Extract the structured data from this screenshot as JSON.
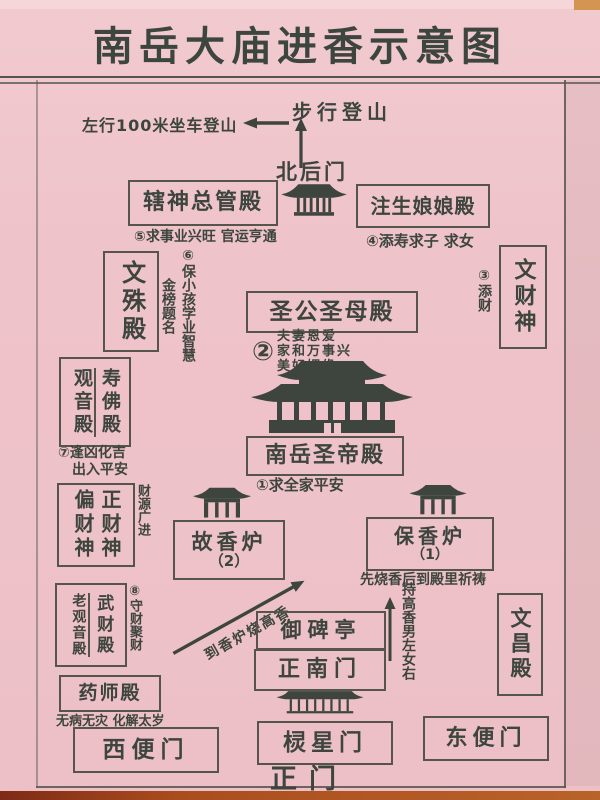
{
  "title": "南岳大庙进香示意图",
  "colors": {
    "paper": "#eec3c9",
    "ink": "#3d453e",
    "line": "#56554c",
    "table": "#a5501f"
  },
  "top_area": {
    "walk_up": "步行登山",
    "ride_up": "左行100米坐车登山",
    "north_back_gate": "北后门"
  },
  "halls": {
    "xiashen": {
      "name": "辖神总管殿",
      "note": "⑤求事业兴旺 官运亨通"
    },
    "zhusheng": {
      "name": "注生娘娘殿",
      "note": "④添寿求子 求女"
    },
    "wenshu": {
      "name": "文殊殿",
      "note_col1": "⑥保小孩学业智慧",
      "note_col2": "金榜题名"
    },
    "wencaishen": {
      "name": "文财神",
      "note": "③添财"
    },
    "shenggongshengmu": {
      "name": "圣公圣母殿",
      "badge": "②",
      "notes": [
        "夫妻恩爱",
        "家和万事兴",
        "美好姻缘"
      ]
    },
    "shengdi": {
      "name": "南岳圣帝殿",
      "note": "①求全家平安"
    },
    "guanyin_shoufo": {
      "left": "观音殿",
      "right": "寿佛殿",
      "note_line1": "⑦逢凶化吉",
      "note_line2": "出入平安"
    },
    "piancai_zhengcai": {
      "left": "偏财神",
      "right": "正财神",
      "note": "财源广进"
    },
    "gu_xianglu": {
      "name": "故香炉",
      "number": "（2）"
    },
    "bao_xianglu": {
      "name": "保香炉",
      "number": "（1）",
      "note": "先烧香后到殿里祈祷"
    },
    "laoguanyin_wucai": {
      "left": "老观音殿",
      "right": "武财殿",
      "note": "⑧守财聚财"
    },
    "yubeiting": {
      "name": "御碑亭"
    },
    "zhengnanmen": {
      "name": "正南门"
    },
    "wenchang": {
      "name": "文昌殿"
    },
    "yaoshi": {
      "name": "药师殿",
      "note": "无病无灾 化解太岁"
    },
    "xibianmen": {
      "name": "西便门"
    },
    "lingxingmen": {
      "name": "棂星门"
    },
    "dongbianmen": {
      "name": "东便门"
    },
    "zhengmen": {
      "name": "正门"
    }
  },
  "annotations": {
    "to_burner": "到香炉烧高香",
    "hold_incense": "持高香男左女右"
  },
  "icons": {
    "pavilion": "temple-pavilion-silhouette",
    "palace": "grand-hall-silhouette",
    "archway": "stone-archway-silhouette",
    "long_gate": "wide-gate-silhouette",
    "up_arrow": "↑",
    "left_arrow": "←",
    "diagonal_arrow": "↗"
  }
}
